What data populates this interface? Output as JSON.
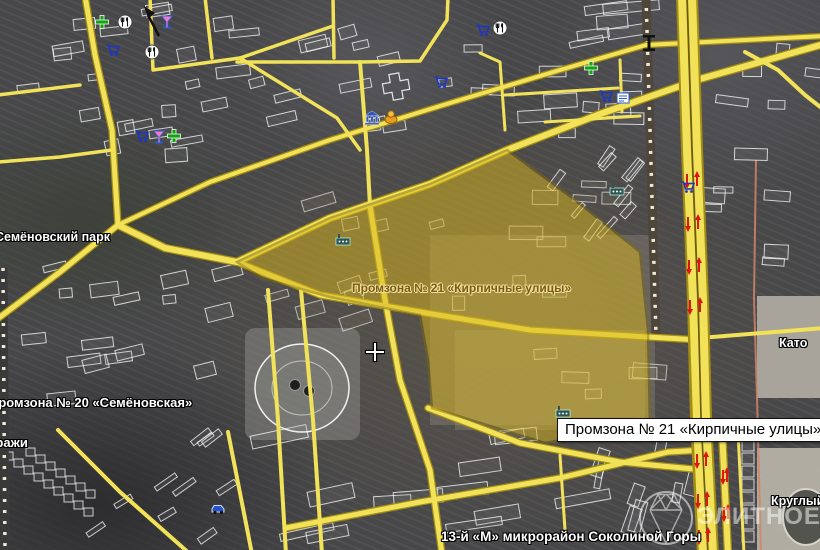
{
  "labels": {
    "park": "Семёновский парк",
    "zone20": "Промзона № 20 «Семёновская»",
    "garages": "Гаражи",
    "zone21": "Промзона № 21 «Кирпичные улицы»",
    "district": "13-й «М» микрорайон Соколиной Горы",
    "kato": "Като",
    "round": "Круглый"
  },
  "tooltip": {
    "text": "Промзона № 21 «Кирпичные улицы»"
  },
  "watermark": {
    "text": "ЭЛИТНОЕ.РУ"
  },
  "colors": {
    "road": "#f2e259",
    "road_casing": "#a38d14",
    "zone_fill": "#d8b61c",
    "zone_border": "#7d6a10",
    "arrow_red": "#e01616",
    "background": "#4a4a4c"
  },
  "icons": [
    {
      "name": "pharmacy",
      "x": 102,
      "y": 22
    },
    {
      "name": "pharmacy",
      "x": 174,
      "y": 136
    },
    {
      "name": "pharmacy",
      "x": 591,
      "y": 68
    },
    {
      "name": "restaurant",
      "x": 125,
      "y": 22
    },
    {
      "name": "restaurant",
      "x": 152,
      "y": 52
    },
    {
      "name": "restaurant",
      "x": 500,
      "y": 28
    },
    {
      "name": "bar",
      "x": 167,
      "y": 22
    },
    {
      "name": "bar",
      "x": 159,
      "y": 137
    },
    {
      "name": "cart",
      "x": 113,
      "y": 50
    },
    {
      "name": "cart",
      "x": 142,
      "y": 136
    },
    {
      "name": "cart",
      "x": 441,
      "y": 82
    },
    {
      "name": "cart",
      "x": 606,
      "y": 96
    },
    {
      "name": "cart",
      "x": 688,
      "y": 187
    },
    {
      "name": "cart",
      "x": 483,
      "y": 30
    },
    {
      "name": "kiosk",
      "x": 623,
      "y": 98
    },
    {
      "name": "bank",
      "x": 372,
      "y": 118
    },
    {
      "name": "dome",
      "x": 391,
      "y": 117
    },
    {
      "name": "factory",
      "x": 343,
      "y": 240
    },
    {
      "name": "factory",
      "x": 563,
      "y": 412
    },
    {
      "name": "factory",
      "x": 617,
      "y": 190
    },
    {
      "name": "car-service",
      "x": 218,
      "y": 508
    }
  ]
}
